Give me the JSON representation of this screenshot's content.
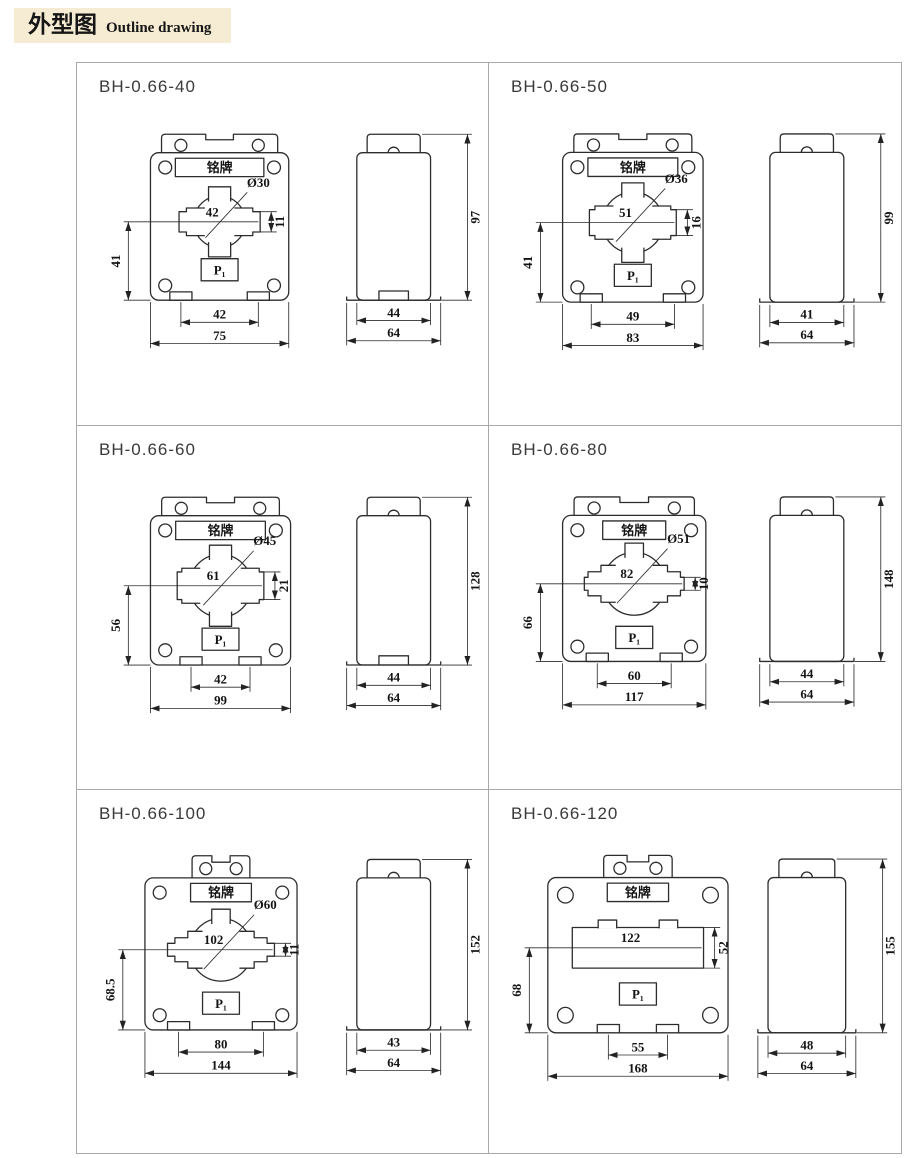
{
  "header": {
    "title_zh": "外型图",
    "title_en": "Outline drawing"
  },
  "labels": {
    "nameplate": "铭牌",
    "p1": "P₁"
  },
  "colors": {
    "header_bg": "#f6ecd3",
    "line": "#2c2c2c",
    "grid_border": "#a9a9a9"
  },
  "panels": [
    {
      "model": "BH-0.66-40",
      "dia": "Ø30",
      "hole_w": "42",
      "hole_h": "11",
      "left_h": "41",
      "foot_span": "42",
      "overall_w": "75",
      "side_bottom": "44",
      "side_overall": "64",
      "side_height": "97"
    },
    {
      "model": "BH-0.66-50",
      "dia": "Ø36",
      "hole_w": "51",
      "hole_h": "16",
      "left_h": "41",
      "foot_span": "49",
      "overall_w": "83",
      "side_bottom": "41",
      "side_overall": "64",
      "side_height": "99"
    },
    {
      "model": "BH-0.66-60",
      "dia": "Ø45",
      "hole_w": "61",
      "hole_h": "21",
      "left_h": "56",
      "foot_span": "42",
      "overall_w": "99",
      "side_bottom": "44",
      "side_overall": "64",
      "side_height": "128"
    },
    {
      "model": "BH-0.66-80",
      "dia": "Ø51",
      "hole_w": "82",
      "hole_h": "10",
      "left_h": "66",
      "foot_span": "60",
      "overall_w": "117",
      "side_bottom": "44",
      "side_overall": "64",
      "side_height": "148"
    },
    {
      "model": "BH-0.66-100",
      "dia": "Ø60",
      "hole_w": "102",
      "hole_h": "11",
      "left_h": "68.5",
      "foot_span": "80",
      "overall_w": "144",
      "side_bottom": "43",
      "side_overall": "64",
      "side_height": "152"
    },
    {
      "model": "BH-0.66-120",
      "dia": "",
      "hole_w": "122",
      "hole_h": "52",
      "left_h": "68",
      "foot_span": "55",
      "overall_w": "168",
      "side_bottom": "48",
      "side_overall": "64",
      "side_height": "155"
    }
  ]
}
